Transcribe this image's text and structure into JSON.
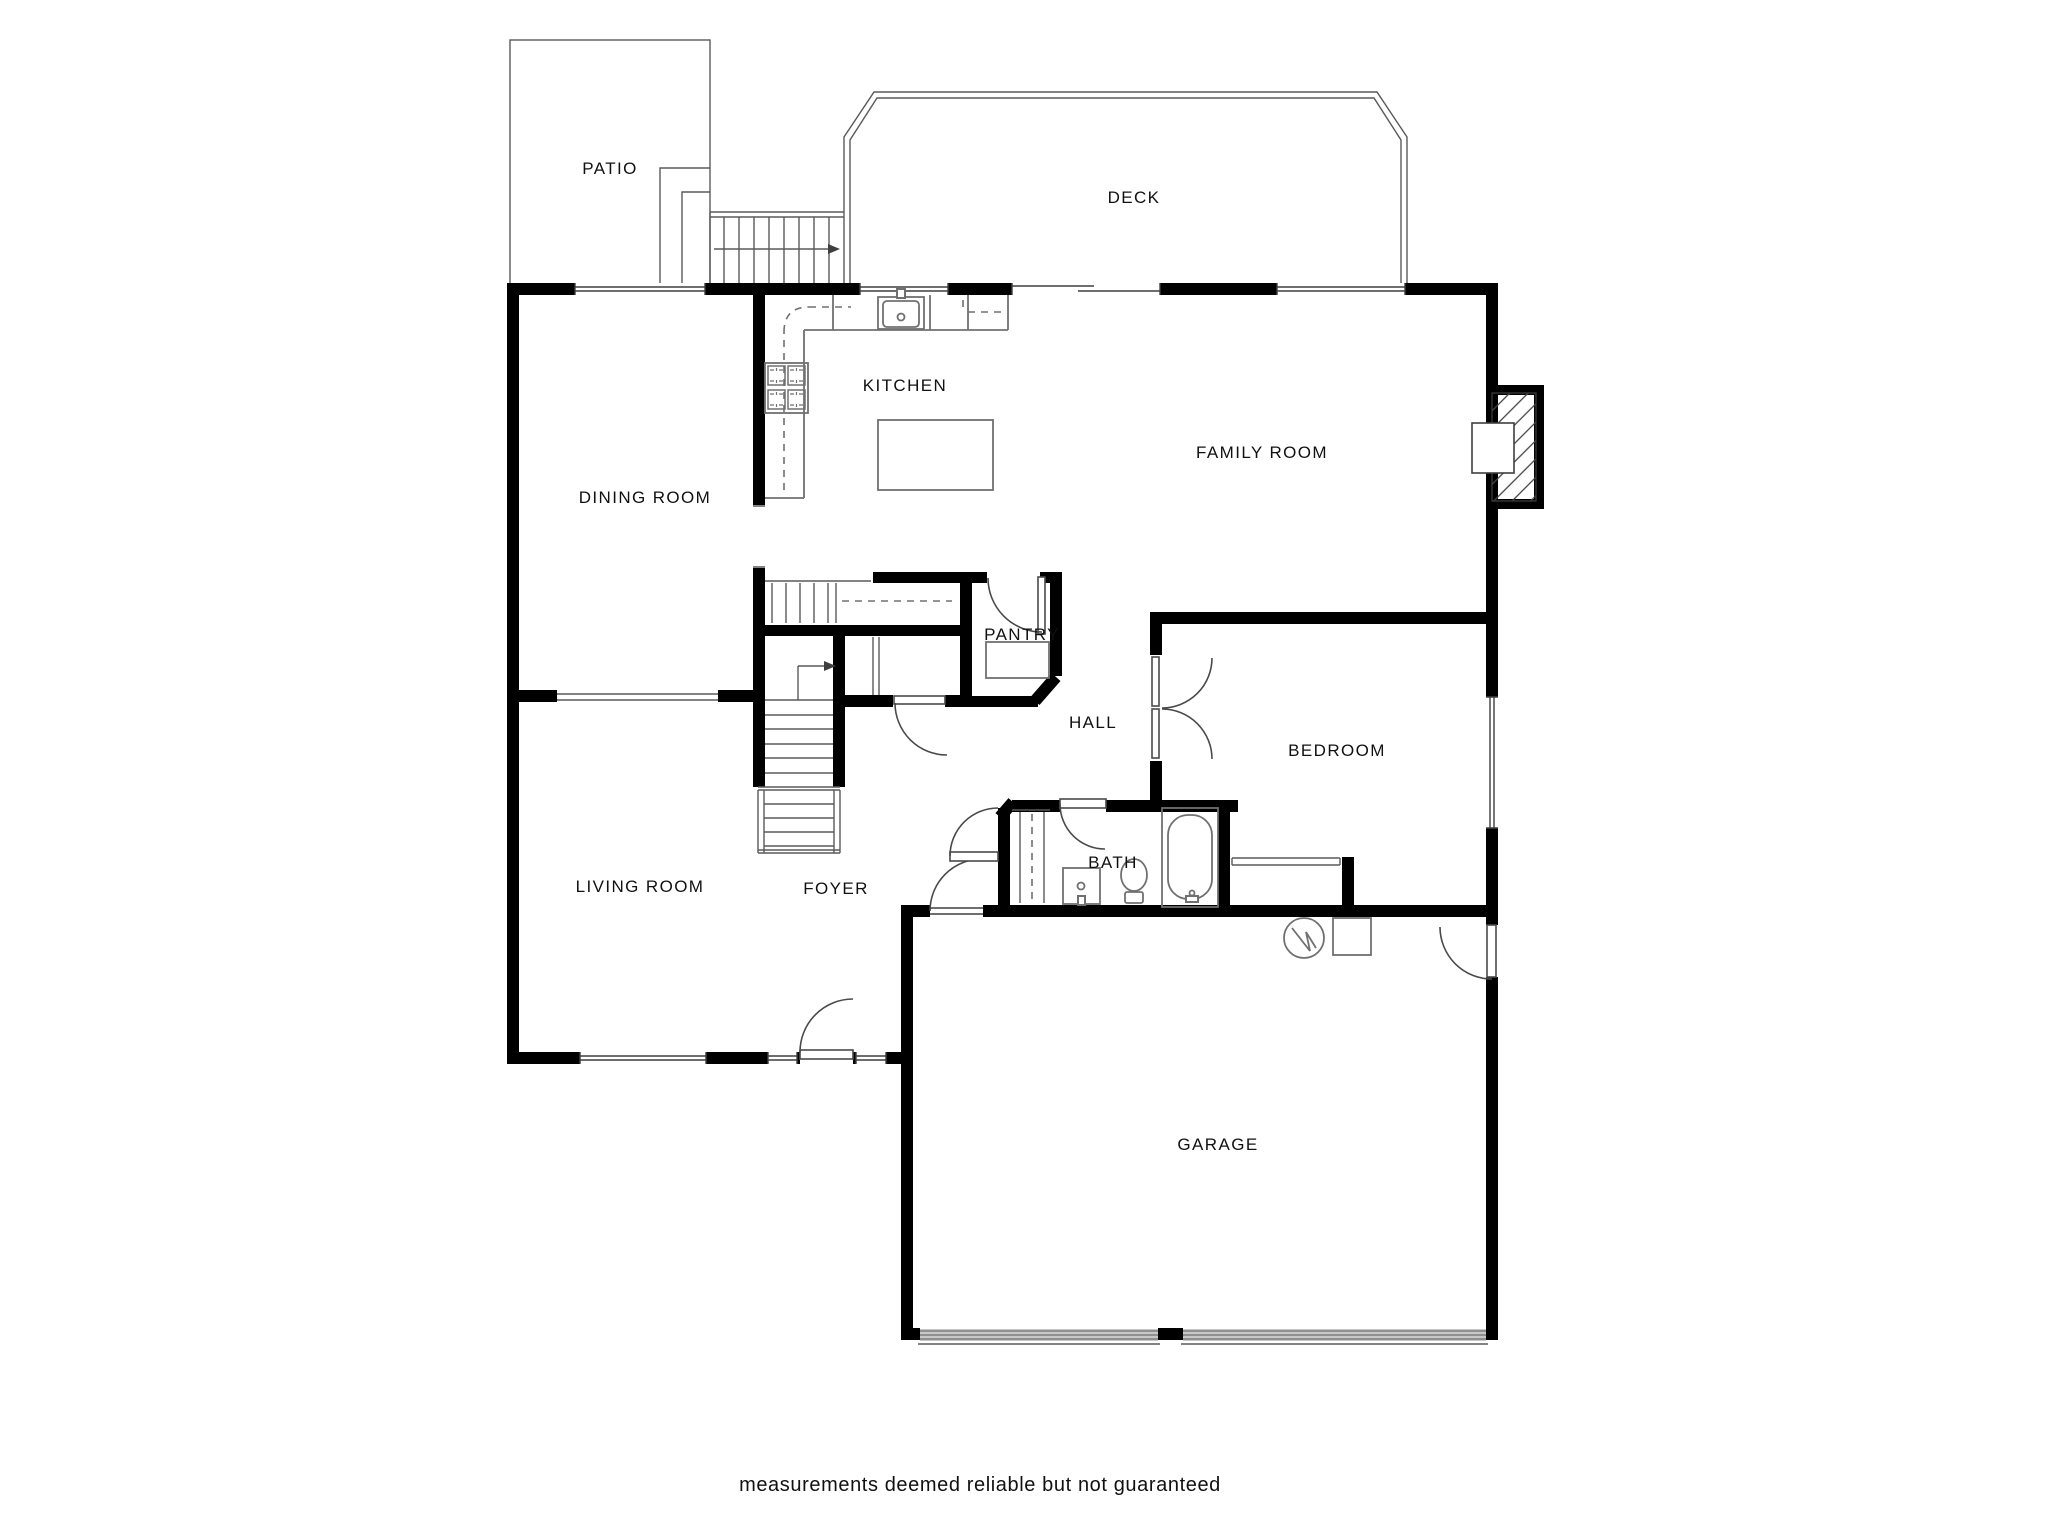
{
  "page": {
    "background": "#ffffff"
  },
  "palette": {
    "wall": "#000000",
    "outline": "#3f3f3f",
    "fixture": "#707070",
    "dashed": "#707070",
    "garage_door": "#8f8f8f",
    "text": "#111111"
  },
  "floor_plan": {
    "labels": {
      "patio": "PATIO",
      "deck": "DECK",
      "kitchen": "KITCHEN",
      "dining_room": "DINING ROOM",
      "family_room": "FAMILY ROOM",
      "pantry": "PANTRY",
      "hall": "HALL",
      "bedroom": "BEDROOM",
      "living_room": "LIVING ROOM",
      "foyer": "FOYER",
      "bath": "BATH",
      "garage": "GARAGE"
    },
    "disclaimer": "measurements deemed reliable but not guaranteed",
    "features": [
      "fireplace",
      "kitchen-sink",
      "cooktop",
      "kitchen-island",
      "pantry-shelves",
      "basement-stairs",
      "main-stairs-up-arrow",
      "deck-stairs-arrow",
      "bathtub",
      "toilet",
      "vanity-sink",
      "linen-closet",
      "bedroom-closet-shelf",
      "water-heater",
      "furnace",
      "garage-doors",
      "front-door",
      "sliding-glass-door",
      "windows"
    ]
  }
}
